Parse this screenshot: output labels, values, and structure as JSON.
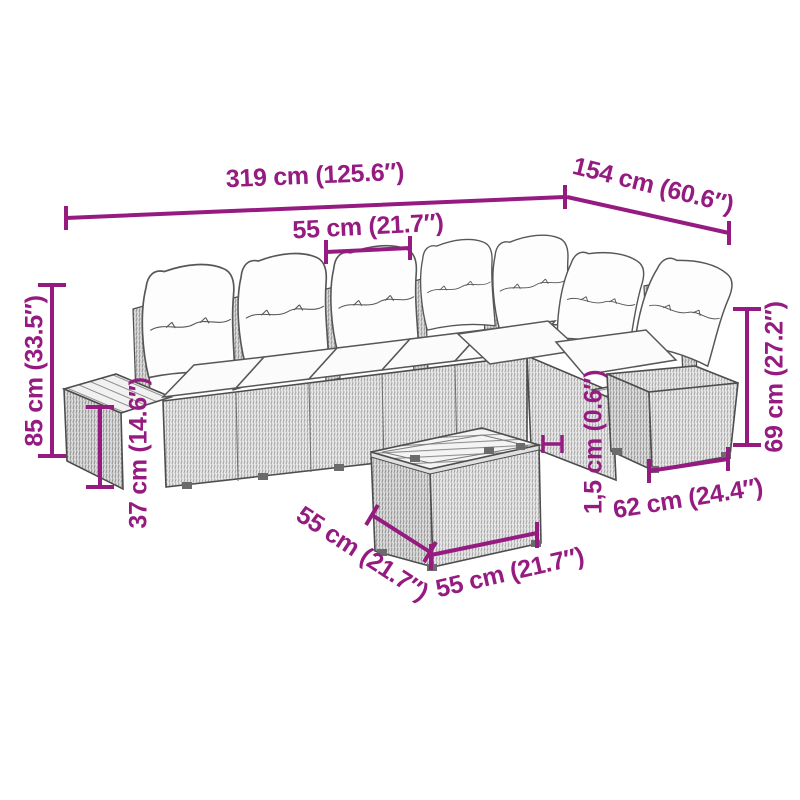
{
  "diagram": {
    "accent_color": "#951b81",
    "dimensions": {
      "width_total": "319 cm (125.6″)",
      "depth_total": "154 cm (60.6″)",
      "seat_module_width": "55 cm (21.7″)",
      "height_total": "85 cm (33.5″)",
      "seat_height": "37 cm (14.6″)",
      "side_height": "69 cm (27.2″)",
      "tabletop_thickness": "1,5 cm (0.6″)",
      "ottoman_width": "62 cm (24.4″)",
      "table_side_depth": "55 cm (21.7″)",
      "table_side_width": "55 cm (21.7″)"
    }
  }
}
